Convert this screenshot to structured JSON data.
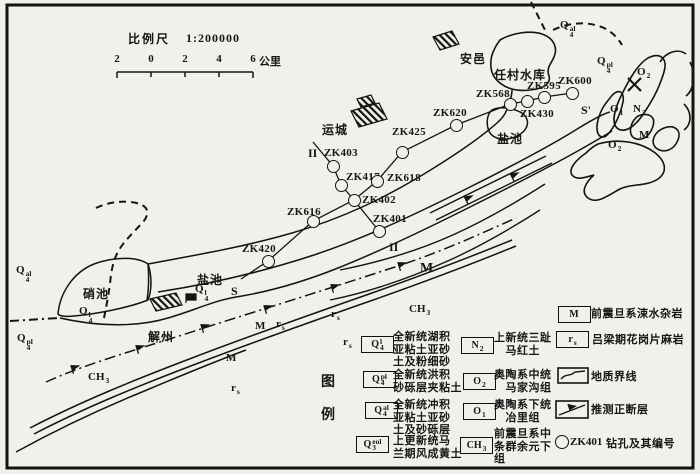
{
  "scale": {
    "label": "比例尺",
    "ratio": "1:200000",
    "ticks": [
      "2",
      "0",
      "2",
      "4",
      "6"
    ],
    "unit": "公里"
  },
  "map": {
    "places": [
      {
        "x": 460,
        "y": 36,
        "text": "安邑"
      },
      {
        "x": 494,
        "y": 52,
        "text": "任村水库"
      },
      {
        "x": 322,
        "y": 107,
        "text": "运城"
      },
      {
        "x": 497,
        "y": 116,
        "text": "盐池"
      },
      {
        "x": 197,
        "y": 257,
        "text": "盐池"
      },
      {
        "x": 83,
        "y": 271,
        "text": "硝池"
      },
      {
        "x": 148,
        "y": 314,
        "text": "解州"
      }
    ],
    "sections": [
      {
        "x": 231,
        "y": 269,
        "text": "S"
      },
      {
        "x": 581,
        "y": 88,
        "text": "S'"
      },
      {
        "x": 308,
        "y": 131,
        "text": "II"
      },
      {
        "x": 389,
        "y": 225,
        "text": "II"
      }
    ],
    "units": [
      {
        "x": 16,
        "y": 252,
        "base": "Q",
        "sub": "4",
        "sup": "al"
      },
      {
        "x": 17,
        "y": 320,
        "base": "Q",
        "sub": "4",
        "sup": "pl"
      },
      {
        "x": 79,
        "y": 293,
        "base": "Q",
        "sub": "4",
        "sup": "l"
      },
      {
        "x": 195,
        "y": 271,
        "base": "Q",
        "sub": "4",
        "sup": "l"
      },
      {
        "x": 560,
        "y": 7,
        "base": "Q",
        "sub": "4",
        "sup": "al"
      },
      {
        "x": 597,
        "y": 43,
        "base": "Q",
        "sub": "4",
        "sup": "pl"
      },
      {
        "x": 637,
        "y": 54,
        "base": "O",
        "sub": "2"
      },
      {
        "x": 610,
        "y": 91,
        "base": "O",
        "sub": "1"
      },
      {
        "x": 633,
        "y": 91,
        "base": "N",
        "sub": "2"
      },
      {
        "x": 639,
        "y": 117,
        "base": "M"
      },
      {
        "x": 608,
        "y": 127,
        "base": "O",
        "sub": "2"
      },
      {
        "x": 420,
        "y": 245,
        "base": "M",
        "cls": "big"
      },
      {
        "x": 255,
        "y": 308,
        "base": "M"
      },
      {
        "x": 226,
        "y": 340,
        "base": "M"
      },
      {
        "x": 276,
        "y": 306,
        "base": "r",
        "sub": "s"
      },
      {
        "x": 331,
        "y": 296,
        "base": "r",
        "sub": "s"
      },
      {
        "x": 343,
        "y": 324,
        "base": "r",
        "sub": "s"
      },
      {
        "x": 231,
        "y": 370,
        "base": "r",
        "sub": "s"
      },
      {
        "x": 88,
        "y": 359,
        "base": "CH",
        "sub": "3"
      },
      {
        "x": 409,
        "y": 291,
        "base": "CH",
        "sub": "3"
      }
    ],
    "boreholes": [
      {
        "id": "ZK403",
        "cx": 333,
        "cy": 166,
        "lx": 324,
        "ly": 147
      },
      {
        "id": "ZK417",
        "cx": 341,
        "cy": 185,
        "lx": 346,
        "ly": 171
      },
      {
        "id": "ZK618",
        "cx": 377,
        "cy": 181,
        "lx": 387,
        "ly": 172
      },
      {
        "id": "ZK402",
        "cx": 354,
        "cy": 200,
        "lx": 362,
        "ly": 194
      },
      {
        "id": "ZK401",
        "cx": 379,
        "cy": 231,
        "lx": 373,
        "ly": 213
      },
      {
        "id": "ZK616",
        "cx": 313,
        "cy": 221,
        "lx": 287,
        "ly": 206
      },
      {
        "id": "ZK420",
        "cx": 268,
        "cy": 261,
        "lx": 242,
        "ly": 243
      },
      {
        "id": "ZK425",
        "cx": 402,
        "cy": 152,
        "lx": 392,
        "ly": 126
      },
      {
        "id": "ZK620",
        "cx": 456,
        "cy": 125,
        "lx": 433,
        "ly": 107
      },
      {
        "id": "ZK568",
        "cx": 510,
        "cy": 104,
        "lx": 476,
        "ly": 88
      },
      {
        "id": "ZK430",
        "cx": 527,
        "cy": 101,
        "lx": 520,
        "ly": 108
      },
      {
        "id": "ZK595",
        "cx": 544,
        "cy": 97,
        "lx": 527,
        "ly": 80
      },
      {
        "id": "ZK600",
        "cx": 572,
        "cy": 93,
        "lx": 558,
        "ly": 75
      }
    ]
  },
  "legend": {
    "title": [
      "图",
      "例"
    ],
    "col1": [
      {
        "bx": 361,
        "by": 336,
        "base": "Q",
        "sub": "4",
        "sup": "l",
        "tx": 393,
        "ty": 331,
        "lines": [
          "全新统湖积",
          "亚粘土亚砂",
          "土及粉细砂"
        ]
      },
      {
        "bx": 363,
        "by": 371,
        "base": "Q",
        "sub": "4",
        "sup": "pl",
        "tx": 393,
        "ty": 369,
        "lines": [
          "全新统洪积",
          "砂砾层夹粘土"
        ]
      },
      {
        "bx": 365,
        "by": 402,
        "base": "Q",
        "sub": "4",
        "sup": "al",
        "tx": 393,
        "ty": 399,
        "lines": [
          "全新统冲积",
          "亚粘土亚砂",
          "土及砂砾层"
        ]
      },
      {
        "bx": 356,
        "by": 436,
        "base": "Q",
        "sub": "3",
        "sup": "eol",
        "tx": 393,
        "ty": 435,
        "lines": [
          "上更新统马",
          "兰期风成黄土"
        ]
      }
    ],
    "col2": [
      {
        "bx": 461,
        "by": 337,
        "base": "N",
        "sub": "2",
        "tx": 494,
        "ty": 332,
        "lines": [
          "上新统三趾",
          "　马红土"
        ]
      },
      {
        "bx": 463,
        "by": 373,
        "base": "O",
        "sub": "2",
        "tx": 494,
        "ty": 369,
        "lines": [
          "奥陶系中统",
          "　马家沟组"
        ]
      },
      {
        "bx": 463,
        "by": 403,
        "base": "O",
        "sub": "1",
        "tx": 494,
        "ty": 399,
        "lines": [
          "奥陶系下统",
          "　冶里组"
        ]
      },
      {
        "bx": 460,
        "by": 437,
        "base": "CH",
        "sub": "3",
        "tx": 494,
        "ty": 428,
        "lines": [
          "前震旦系中",
          "条群余元下",
          "组"
        ]
      }
    ],
    "col3": [
      {
        "kind": "box",
        "bx": 558,
        "by": 306,
        "base": "M",
        "tx": 591,
        "ty": 308,
        "text": "前震旦系涑水杂岩"
      },
      {
        "kind": "box",
        "bx": 556,
        "by": 331,
        "base": "r",
        "sub": "s",
        "tx": 592,
        "ty": 334,
        "text": "吕梁期花岗片麻岩"
      },
      {
        "kind": "boundary",
        "bx": 557,
        "by": 367,
        "tx": 591,
        "ty": 371,
        "text": "地质界线"
      },
      {
        "kind": "fault",
        "bx": 555,
        "by": 400,
        "tx": 591,
        "ty": 404,
        "text": "推测正断层"
      },
      {
        "kind": "borehole",
        "bx": 555,
        "by": 435,
        "sym": "ZK401",
        "tx": 606,
        "ty": 438,
        "text": "钻孔及其编号"
      }
    ]
  }
}
